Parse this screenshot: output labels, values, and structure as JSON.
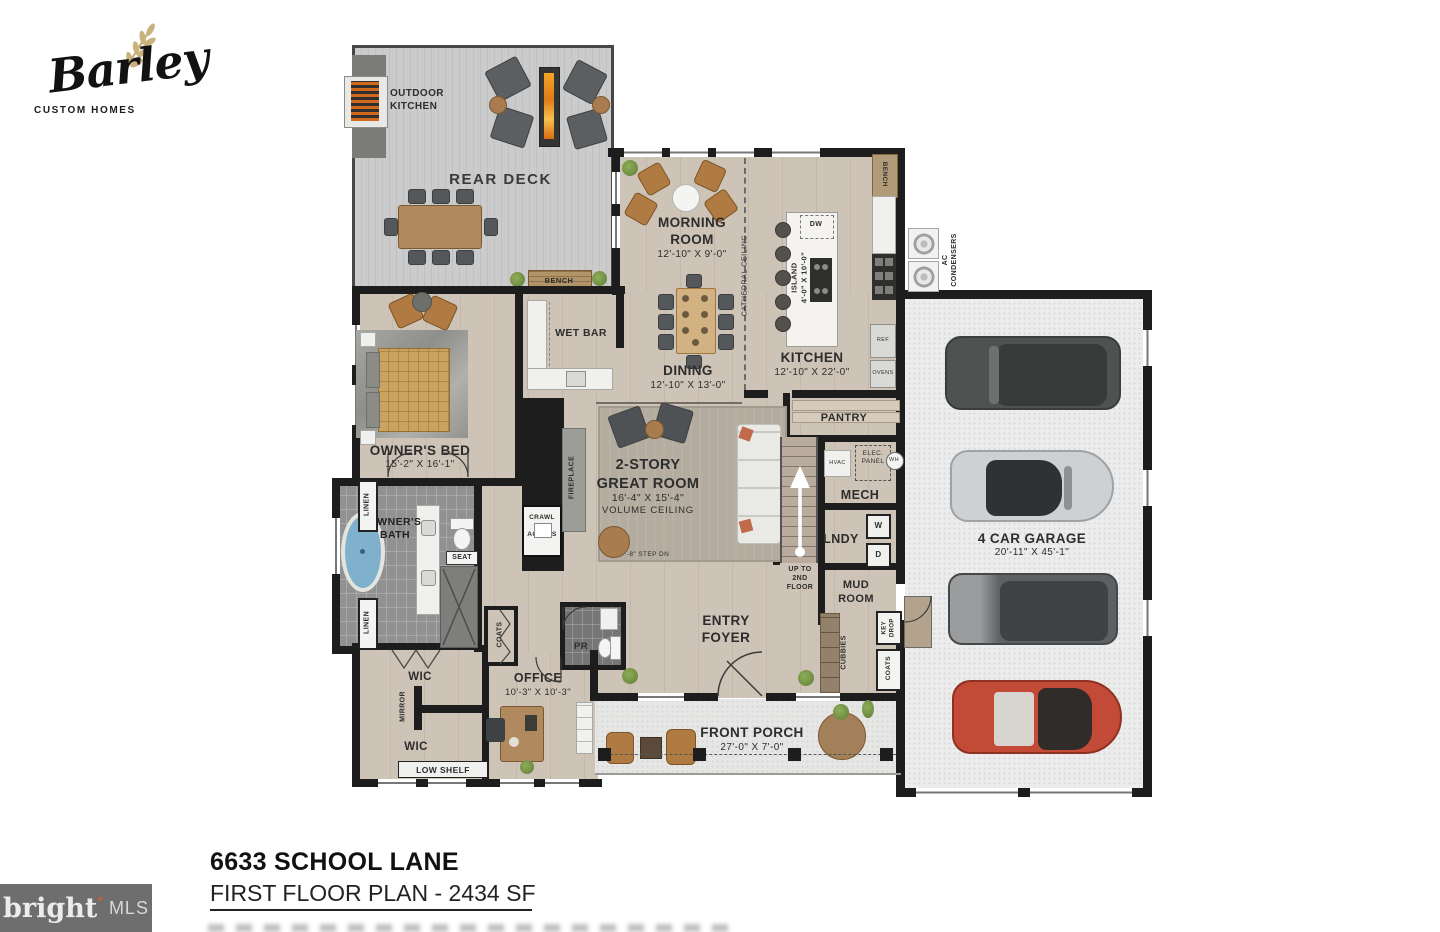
{
  "document": {
    "logo": {
      "brand": "Barley",
      "tagline": "CUSTOM HOMES"
    },
    "watermark": {
      "brand": "bright",
      "star": "✶",
      "suffix": "MLS"
    },
    "footer": {
      "address": "6633 SCHOOL LANE",
      "plan_title": "FIRST FLOOR PLAN - 2434 SF"
    }
  },
  "colors": {
    "wall": "#1d1d1d",
    "wood_floor": "#cdc3b6",
    "deck": "#c7c7c7",
    "bath_tile": "#919191",
    "garage_floor": "#ececec",
    "flame": "#e8862c",
    "tub_water": "#7fb0cc",
    "bench_wood": "#b29b79",
    "car_red": "#c24a36",
    "watermark_bg": "#6e6e6e"
  },
  "rooms": {
    "rear_deck": {
      "name": "REAR DECK"
    },
    "outdoor_kitchen": {
      "name": "OUTDOOR\nKITCHEN"
    },
    "morning_room": {
      "name": "MORNING\nROOM",
      "dims": "12'-10\" X 9'-0\""
    },
    "dining": {
      "name": "DINING",
      "dims": "12'-10\" X 13'-0\""
    },
    "kitchen": {
      "name": "KITCHEN",
      "dims": "12'-10\" X 22'-0\""
    },
    "island": {
      "name": "ISLAND\n4'-0\" X 10'-0\""
    },
    "garage": {
      "name": "4 CAR GARAGE",
      "dims": "20'-11\" X 45'-1\""
    },
    "owners_bed": {
      "name": "OWNER'S BED",
      "dims": "15'-2\" X 16'-1\""
    },
    "owners_bath": {
      "name": "OWNER'S\nBATH"
    },
    "wet_bar": {
      "name": "WET BAR"
    },
    "great_room": {
      "name": "2-STORY\nGREAT ROOM",
      "dims": "16'-4\" X 15'-4\"",
      "note": "VOLUME CEILING",
      "step": "-8\" STEP DN"
    },
    "pantry": {
      "name": "PANTRY"
    },
    "mech": {
      "name": "MECH"
    },
    "laundry": {
      "name": "LNDY"
    },
    "mud_room": {
      "name": "MUD\nROOM"
    },
    "entry_foyer": {
      "name": "ENTRY\nFOYER"
    },
    "office": {
      "name": "OFFICE",
      "dims": "10'-3\" X 10'-3\""
    },
    "powder_room": {
      "name": "PR"
    },
    "front_porch": {
      "name": "FRONT PORCH",
      "dims": "27'-0\" X 7'-0\""
    },
    "wic1": {
      "name": "WIC"
    },
    "wic2": {
      "name": "WIC"
    }
  },
  "features": {
    "deck_bench": "BENCH",
    "kitchen_bench": "BENCH",
    "cathedral": "CATHEDRAL CEILING",
    "dw": "DW",
    "ref": "REF",
    "ovens": "OVENS",
    "ac": "AC\nCONDENSERS",
    "fireplace": "FIREPLACE",
    "crawl": "CRAWL\nACCESS",
    "hvac": "HVAC",
    "elec": "ELEC.\nPANEL",
    "wh": "WH",
    "washer": "W",
    "dryer": "D",
    "up_stairs": "UP TO\n2ND\nFLOOR",
    "key_drop": "KEY\nDROP",
    "cubbies": "CUBBIES",
    "coats_mud": "COATS",
    "coats_office": "COATS",
    "linen1": "LINEN",
    "linen2": "LINEN",
    "seat": "SEAT",
    "mirror": "MIRROR",
    "low_shelf": "LOW SHELF"
  }
}
